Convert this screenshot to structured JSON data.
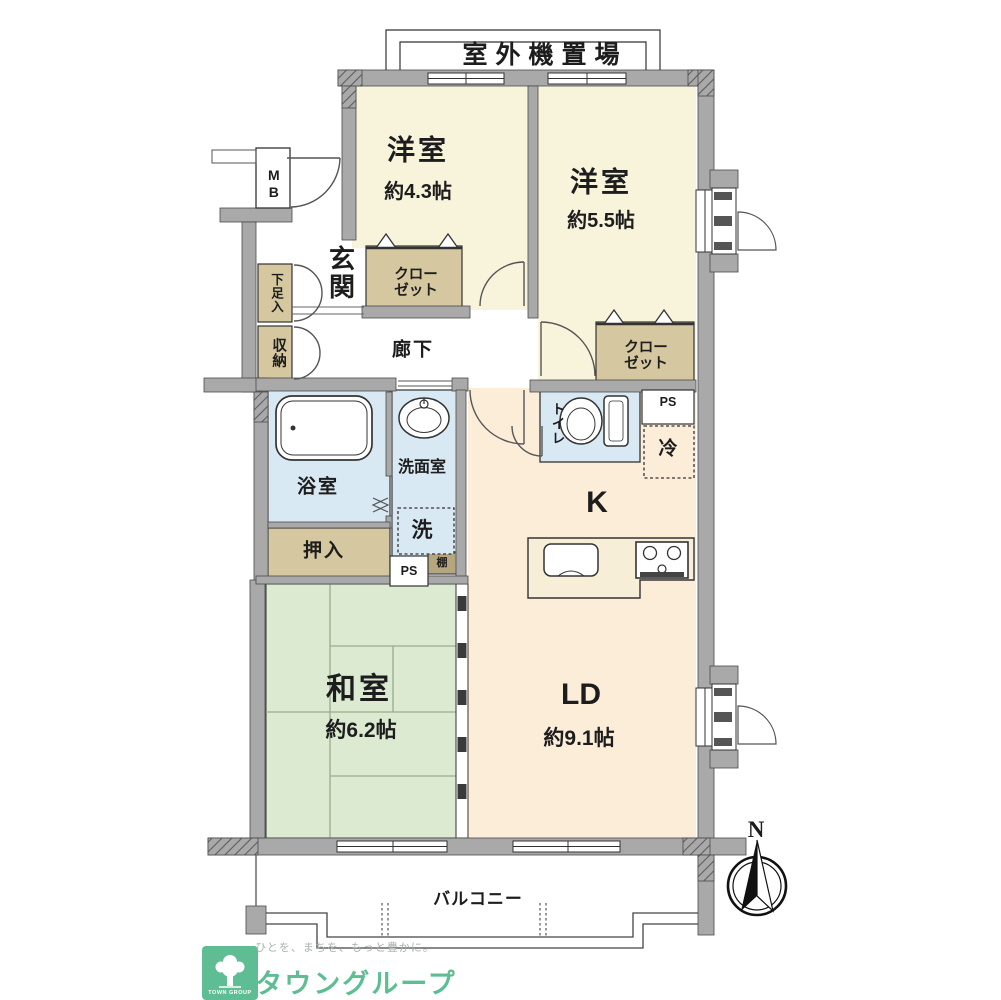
{
  "plan": {
    "outdoor_unit_label": "室外機置場",
    "rooms": {
      "yoshitsu1": {
        "name": "洋室",
        "size": "約4.3帖"
      },
      "yoshitsu2": {
        "name": "洋室",
        "size": "約5.5帖"
      },
      "washitsu": {
        "name": "和室",
        "size": "約6.2帖"
      },
      "ld": {
        "name": "LD",
        "size": "約9.1帖"
      },
      "kitchen": "K",
      "genkan": "玄関",
      "hallway": "廊下",
      "bath": "浴室",
      "washroom": "洗面室",
      "toilet": "トイレ",
      "balcony": "バルコニー"
    },
    "storage": {
      "closet1": {
        "line1": "クロー",
        "line2": "ゼット"
      },
      "closet2": {
        "line1": "クロー",
        "line2": "ゼット"
      },
      "shoe_box": "下足入",
      "storage_box": "収納",
      "oshiire": "押入",
      "shelf": "棚"
    },
    "labels": {
      "washer": "洗",
      "fridge": "冷",
      "meter_box": "MB",
      "ps_left": "PS",
      "ps_right": "PS",
      "north": "N"
    },
    "footer": {
      "tagline": "ひとを、まちを、もっと豊かに。",
      "brand": "タウングループ",
      "logo_text": "TOWN GROUP"
    },
    "colors": {
      "western_room": "#f8f4dc",
      "living_kitchen": "#fcedd9",
      "tatami": "#dcead2",
      "water": "#d9e9f4",
      "closet": "#d5c79f",
      "wall": "#a9a9a9",
      "brand_green": "#5fbd93"
    }
  }
}
